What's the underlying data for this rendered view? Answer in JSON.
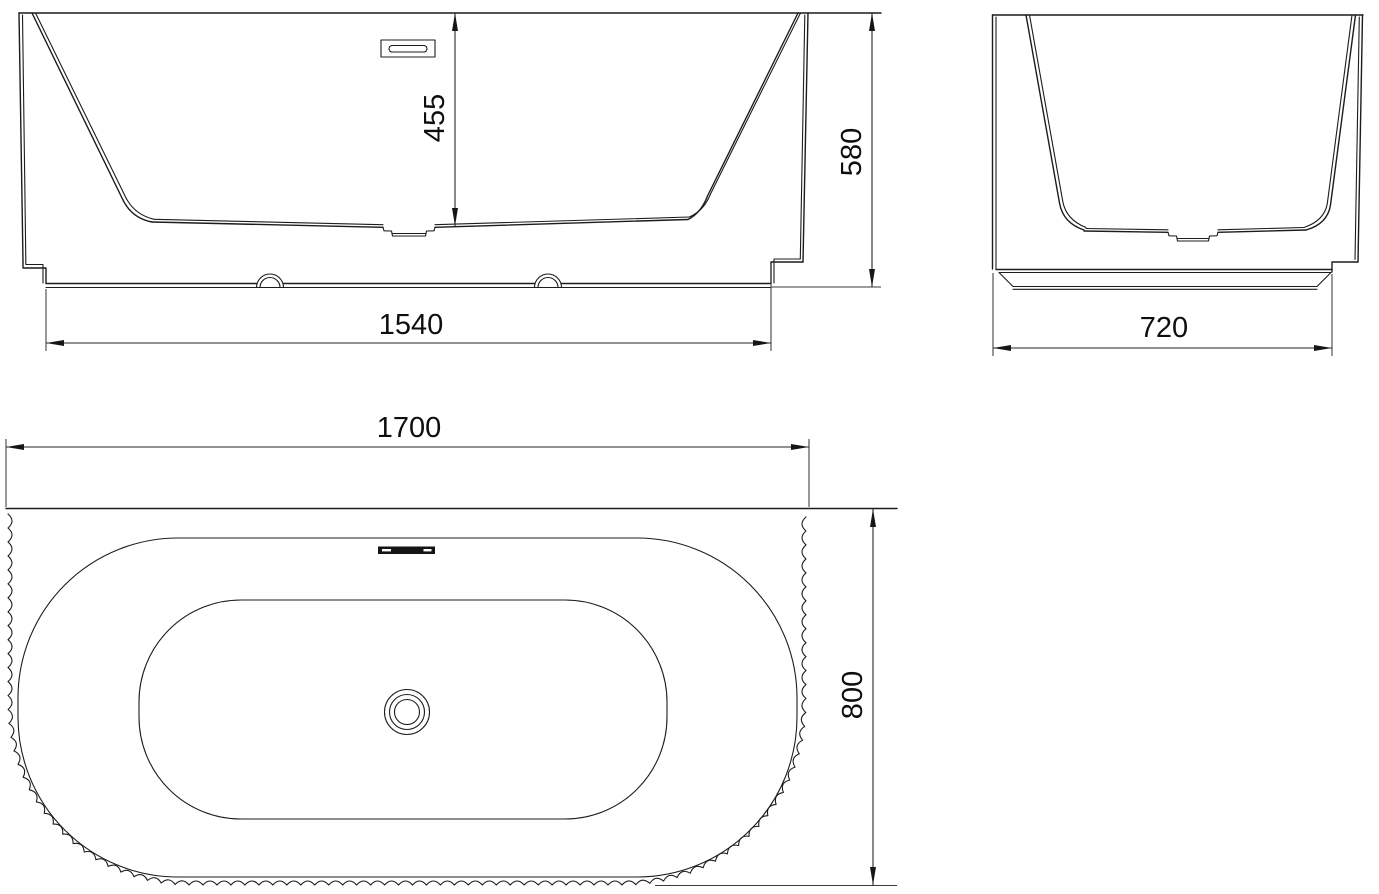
{
  "title": "Bathtub technical drawing – three orthographic views",
  "colors": {
    "background": "#ffffff",
    "line": "#1c1c1c",
    "text": "#0e0e0e"
  },
  "views": {
    "front": {
      "label": "front-elevation"
    },
    "side": {
      "label": "side-elevation"
    },
    "plan": {
      "label": "top-plan-view"
    }
  },
  "dimensions": {
    "inner_depth": {
      "value": "455"
    },
    "overall_height": {
      "value": "580"
    },
    "base_length": {
      "value": "1540"
    },
    "base_width": {
      "value": "720"
    },
    "overall_length": {
      "value": "1700"
    },
    "overall_width": {
      "value": "800"
    }
  },
  "symbols": {
    "drain": "concentric-circles-drain",
    "overflow": "overflow-slot"
  }
}
